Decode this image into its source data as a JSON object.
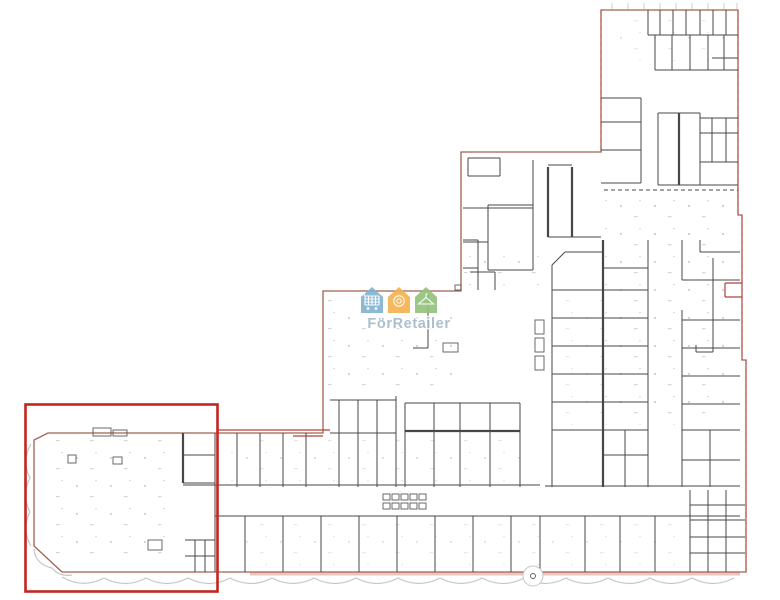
{
  "page": {
    "description_label": "building floor plan drawing with highlighted premises"
  },
  "watermark": {
    "brand_text": "FörRetailer",
    "text_color": "#9db4c6",
    "houses": [
      {
        "label": "retail-house",
        "color": "#7fb2cf",
        "icon": "shopping-cart-icon"
      },
      {
        "label": "food-house",
        "color": "#f4b04e",
        "icon": "plate-icon"
      },
      {
        "label": "fashion-house",
        "color": "#92c17a",
        "icon": "hanger-icon"
      }
    ],
    "icon_color": "#ffffff"
  },
  "highlight": {
    "label": "selected-premises-outline",
    "color": "#c1261f"
  },
  "plan": {
    "wall_color": "#474747",
    "boundary_color": "#a2604d",
    "accent_wall_color": "#b5413a",
    "landscape_color": "#c6c6c6",
    "ground_band_color": "#e5b7b0",
    "tick_color": "#c2c2c2",
    "fixture_color": "#5a5a5a",
    "texture_color": "#c2c2c2"
  }
}
